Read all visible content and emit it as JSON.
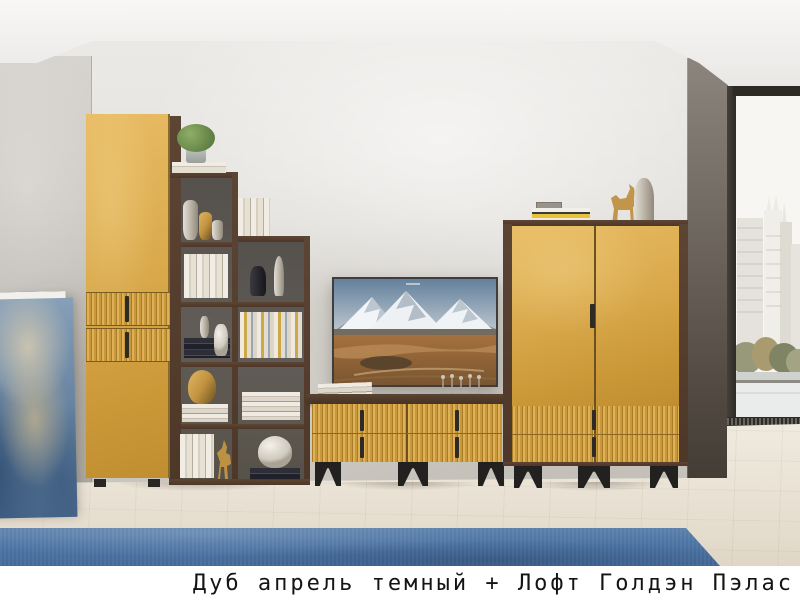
{
  "caption": {
    "text": "Дуб апрель темный + Лофт Голдэн Пэлас"
  },
  "scene": {
    "items": [
      "abstract painting leaning on wall",
      "tall gold cabinet with slatted drawers",
      "dark wood staircase shelving with books and vases",
      "wall mounted tv showing snowy mountains",
      "gold slatted tv stand on black metal legs",
      "two-door gold wardrobe with slatted drawers",
      "floor-to-ceiling window with city view",
      "blue carpet on light wood floor"
    ]
  },
  "palette": {
    "gold_accent": "#d9a94b",
    "dark_wood": "#4f3a2c",
    "rug_blue": "#4b73a3",
    "wall_gray": "#e4e2de",
    "floor_wood": "#e8e1d3",
    "caption_bg": "#ffffff",
    "caption_text": "#141414"
  }
}
